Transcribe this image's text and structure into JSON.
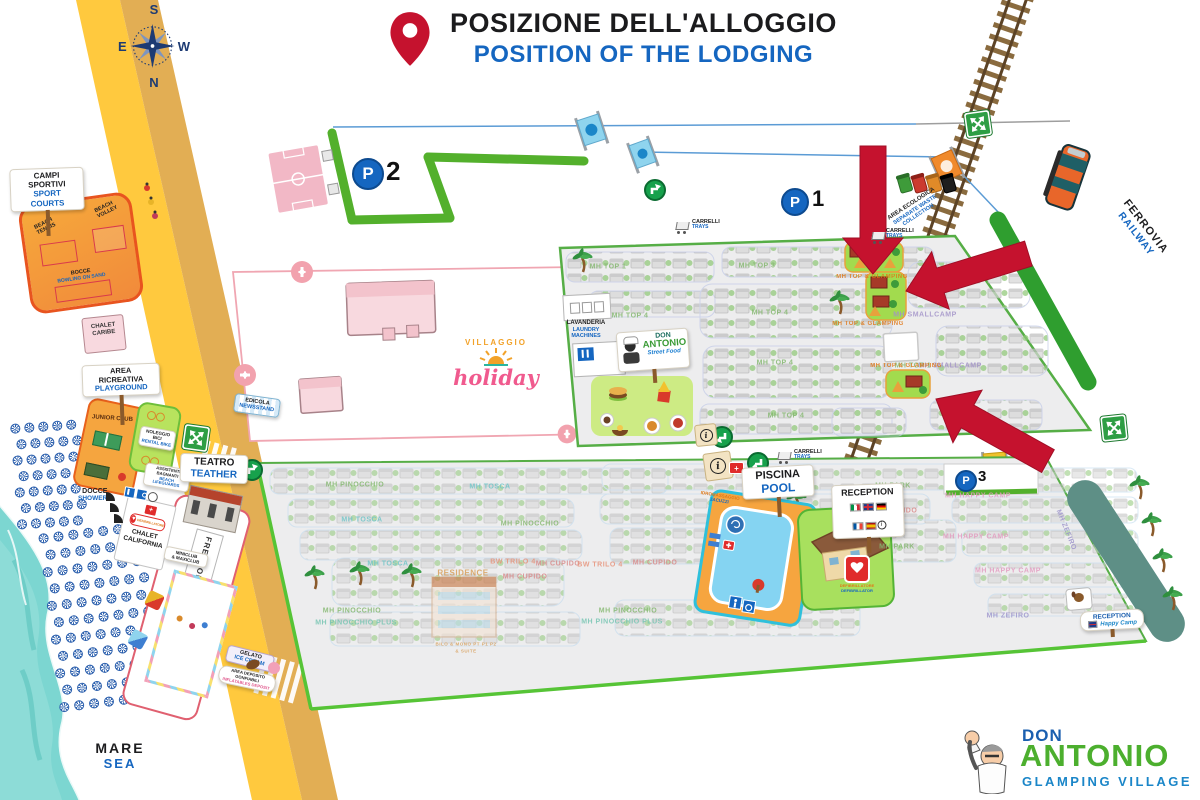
{
  "header": {
    "title_it": "POSIZIONE DELL'ALLOGGIO",
    "title_en": "POSITION OF THE LODGING"
  },
  "compass": {
    "top": "S",
    "left": "E",
    "right": "W",
    "bottom": "N"
  },
  "labels": {
    "mare_it": "MARE",
    "mare_en": "SEA",
    "ferrovia_it": "FERROVIA",
    "ferrovia_en": "RAILWAY"
  },
  "parking": {
    "symbol": "P",
    "p1": "1",
    "p2": "2",
    "p3": "3"
  },
  "signs": {
    "sport_courts": {
      "it": "CAMPI SPORTIVI",
      "en": "SPORT COURTS"
    },
    "beach_tennis": "BEACH TENNIS",
    "beach_volley": "BEACH VOLLEY",
    "bocce": {
      "it": "BOCCE",
      "en": "BOWLING ON SAND"
    },
    "chalet_caribe": "CHALET CARIBE",
    "area_ricreativa": {
      "it": "AREA RICREATIVA",
      "en": "PLAYGROUND"
    },
    "junior_club": "JUNIOR CLUB",
    "noleggio_bici": {
      "it": "NOLEGGIO BICI",
      "en": "RENTAL BIKE"
    },
    "teatro": {
      "it": "TEATRO",
      "en": "TEATHER"
    },
    "docce": {
      "it": "DOCCE",
      "en": "SHOWERS"
    },
    "lifeguards": {
      "it": "ASSISTENTI BAGNANTI",
      "en": "BEACH LIFEGUARDS"
    },
    "chalet_california": "CHALET CALIFORNIA",
    "defibrillatore": {
      "it": "DEFIBRILLATORE",
      "en": "DEFIBRILLATOR"
    },
    "frescobar": "FRESCOBAR",
    "miniclub": {
      "l1": "MINICLUB",
      "l2": "& MAXICLUB"
    },
    "gelato": {
      "it": "GELATO",
      "en": "ICE CREAM"
    },
    "gonfiabili": {
      "it": "AREA DEPOSITO GONFIABILI",
      "en": "INFLATABLES DEPOSIT"
    },
    "edicola": {
      "it": "EDICOLA",
      "en": "NEWSSTAND"
    },
    "villaggio_holiday": {
      "top": "VILLAGGIO",
      "bottom": "holiday"
    },
    "lavanderia": {
      "it": "LAVANDERIA",
      "en": "LAUNDRY MACHINES"
    },
    "street_food": {
      "l1": "DON",
      "l2": "ANTONIO",
      "l3": "Street Food"
    },
    "area_ecologica": {
      "it": "AREA ECOLOGICA",
      "en": "SEPARATE WASTE COLLECTION"
    },
    "carrelli": {
      "it": "CARRELLI",
      "en": "TRAYS"
    },
    "piscina": {
      "it": "PISCINA",
      "en": "POOL"
    },
    "idromassaggio": {
      "it": "IDROMASSAGGIO",
      "en": "JACUZZI"
    },
    "reception": "RECEPTION",
    "reception_hc": {
      "l1": "RECEPTION",
      "l2": "Happy Camp"
    }
  },
  "logo": {
    "don": "DON",
    "antonio": "ANTONIO",
    "tagline": "GLAMPING VILLAGE"
  },
  "map_labels": [
    {
      "t": "MH TOP 1",
      "x": 608,
      "y": 267,
      "c": "#84B86F"
    },
    {
      "t": "MH TOP 3",
      "x": 757,
      "y": 266,
      "c": "#84B86F"
    },
    {
      "t": "MH TOP 4",
      "x": 630,
      "y": 316,
      "c": "#84B86F"
    },
    {
      "t": "MH TOP 4",
      "x": 770,
      "y": 313,
      "c": "#84B86F"
    },
    {
      "t": "MH TOP 4",
      "x": 775,
      "y": 363,
      "c": "#84B86F"
    },
    {
      "t": "MH TOP 4",
      "x": 786,
      "y": 416,
      "c": "#84B86F"
    },
    {
      "t": "MH SMALLCAMP",
      "x": 925,
      "y": 315,
      "c": "#A393C9"
    },
    {
      "t": "MH SMALLCAMP",
      "x": 950,
      "y": 366,
      "c": "#A393C9"
    },
    {
      "t": "MH TOP 1",
      "x": 913,
      "y": 366,
      "c": "#84B86F"
    },
    {
      "t": "MH TOP & GLAMPING",
      "x": 872,
      "y": 277,
      "c": "#E07818",
      "s": 6
    },
    {
      "t": "MH TOP & GLAMPING",
      "x": 868,
      "y": 324,
      "c": "#E07818",
      "s": 6
    },
    {
      "t": "MH TOP & GLAMPING",
      "x": 906,
      "y": 366,
      "c": "#E07818",
      "s": 6
    },
    {
      "t": "MH PINOCCHIO",
      "x": 355,
      "y": 485,
      "c": "#84B86F"
    },
    {
      "t": "MH TOSCA",
      "x": 490,
      "y": 487,
      "c": "#6FC5C8"
    },
    {
      "t": "MH TOSCA",
      "x": 362,
      "y": 520,
      "c": "#6FC5C8"
    },
    {
      "t": "MH PINOCCHIO",
      "x": 530,
      "y": 524,
      "c": "#84B86F"
    },
    {
      "t": "MH TOSCA",
      "x": 388,
      "y": 564,
      "c": "#6FC5C8"
    },
    {
      "t": "BW TRILO 4",
      "x": 513,
      "y": 562,
      "c": "#E8937A"
    },
    {
      "t": "MH CUPIDO",
      "x": 558,
      "y": 564,
      "c": "#D98A8A"
    },
    {
      "t": "BW TRILO 4",
      "x": 600,
      "y": 565,
      "c": "#E8937A"
    },
    {
      "t": "MH CUPIDO",
      "x": 655,
      "y": 563,
      "c": "#D98A8A"
    },
    {
      "t": "RESIDENCE",
      "x": 463,
      "y": 573,
      "c": "#D9A05B",
      "s": 8
    },
    {
      "t": "MH CUPIDO",
      "x": 525,
      "y": 577,
      "c": "#D98A8A"
    },
    {
      "t": "BILO & MONO PT P1 P2",
      "x": 466,
      "y": 644,
      "c": "#D9A05B",
      "s": 4.5
    },
    {
      "t": "& SUITE",
      "x": 466,
      "y": 651,
      "c": "#D9A05B",
      "s": 4.5
    },
    {
      "t": "MH PINOCCHIO",
      "x": 352,
      "y": 611,
      "c": "#84B86F"
    },
    {
      "t": "MH PINOCCHIO PLUS",
      "x": 356,
      "y": 623,
      "c": "#76C5B2"
    },
    {
      "t": "MH PINOCCHIO",
      "x": 628,
      "y": 611,
      "c": "#84B86F"
    },
    {
      "t": "MH PINOCCHIO PLUS",
      "x": 622,
      "y": 622,
      "c": "#76C5B2"
    },
    {
      "t": "MH PARK",
      "x": 893,
      "y": 486,
      "c": "#84B86F"
    },
    {
      "t": "MH CUPIDO",
      "x": 895,
      "y": 511,
      "c": "#D98A8A"
    },
    {
      "t": "MH PARK",
      "x": 897,
      "y": 547,
      "c": "#84B86F"
    },
    {
      "t": "MH HAPPY CAMP",
      "x": 978,
      "y": 496,
      "c": "#E39BC0"
    },
    {
      "t": "MH HAPPY CAMP",
      "x": 976,
      "y": 537,
      "c": "#E39BC0"
    },
    {
      "t": "MH HAPPY CAMP",
      "x": 1008,
      "y": 571,
      "c": "#E39BC0"
    },
    {
      "t": "MH ZEFIRO",
      "x": 1008,
      "y": 616,
      "c": "#9E95CC"
    },
    {
      "t": "MH ZEFIRO",
      "x": 1066,
      "y": 530,
      "c": "#9E95CC",
      "r": 68
    }
  ],
  "umbrella_patches": [
    {
      "x": 10,
      "y": 424,
      "rows": 7,
      "cols": 5,
      "dx": 14,
      "dy": 16,
      "rot": -4
    },
    {
      "x": 38,
      "y": 534,
      "rows": 11,
      "cols": 7,
      "dx": 15,
      "dy": 17,
      "rot": -7
    }
  ],
  "accent_colors": {
    "arrow_red": "#C5122E",
    "title_blue": "#1566C0",
    "brand_green": "#4CAF2E"
  }
}
